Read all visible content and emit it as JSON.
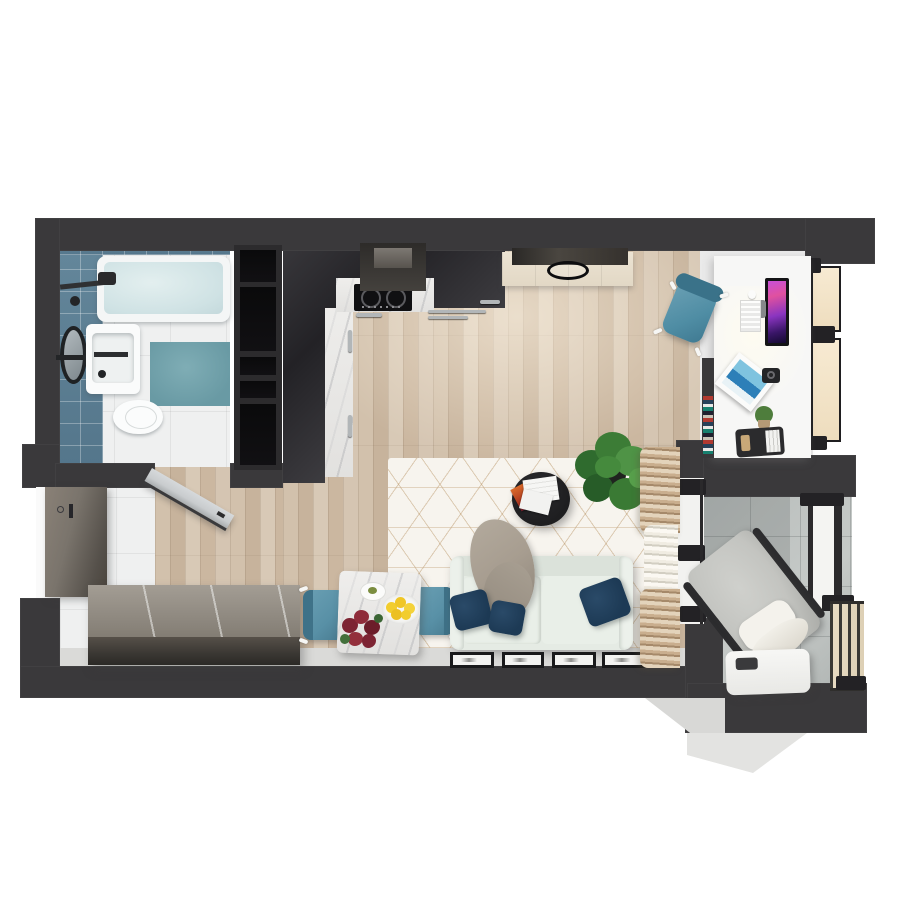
{
  "meta": {
    "title": "Studio apartment – top-down 3D floor plan render",
    "view": "top-down-3d-render",
    "canvas_px": {
      "width": 900,
      "height": 900
    },
    "background": "#ffffff",
    "visible_text": "none"
  },
  "palette": {
    "wall": "#3a393b",
    "niche": "#0a0a0b",
    "tileBlue": "#64879b",
    "bathMatTeal": "#699aa4",
    "woodLight": "#d8c9b6",
    "woodDark": "#c7b39c",
    "hallTile": "#eff0f0",
    "balconyTile": "#bcc1bf",
    "marble": "#efeeec",
    "rugBase": "#f7f4ee",
    "rugLine": "#ba9668",
    "sofa": "#e5ebe4",
    "pillowNavy": "#1d3a55",
    "throwTaupe": "#a79d90",
    "coffeeTableBlack": "#1e1e20",
    "chairBlue": "#5890a6",
    "curtainTan": "#c9ae8e",
    "curtainWhite": "#f0ece2",
    "lemon": "#f2cd2e",
    "flower": "#7d2433",
    "plantGreen": "#3c7c36",
    "glassCream": "#f7ead2",
    "deskWhite": "#f7f7f6",
    "monitorScreenMagenta": "#c84fd8",
    "sideboardTop": "#a39d94",
    "sideboardFront": "#3a3733",
    "doorGray": "#c9ccce",
    "entranceDoorBrownGray": "#7a746c",
    "loungeChairGray": "#c3c4c0"
  },
  "rooms": [
    {
      "id": "bathroom",
      "name": "bathroom",
      "floor": "white tile with blue tiled feature wall",
      "items": [
        "bathtub",
        "shower-mixer",
        "round-mirror",
        "towel-bar",
        "washbasin",
        "toilet",
        "teal-bath-mat",
        "open-interior-door"
      ]
    },
    {
      "id": "entry-hall",
      "name": "entry hall",
      "floor": "white tile",
      "items": [
        "entrance-door",
        "long-dark-sideboard"
      ]
    },
    {
      "id": "kitchen",
      "name": "kitchen",
      "floor": "wood planks",
      "items": [
        "dark-l-shaped-cabinets",
        "white-marble-counter",
        "induction-hob-2-burners",
        "extractor-hood",
        "tall-black-shelving-unit",
        "steel-handle-bars"
      ]
    },
    {
      "id": "living-dining",
      "name": "living / dining room",
      "floor": "wood planks",
      "items": [
        "geometric-white-rug",
        "light-green-sofa",
        "navy-pillows-x3",
        "taupe-throw-blanket",
        "round-black-coffee-table",
        "magazines",
        "potted-plant",
        "square-marble-dining-table",
        "blue-dining-chairs-x2",
        "lemon-bowl",
        "red-flower-vase",
        "small-plate",
        "tv-cabinet-beige",
        "wall-tv-panel",
        "ceiling-lamp-ring",
        "leaning-picture-frames-x4",
        "floor-to-ceiling-curtains"
      ]
    },
    {
      "id": "work-nook",
      "name": "work nook",
      "floor": "white",
      "items": [
        "white-desk",
        "monitor-magenta-screen",
        "white-keyboard",
        "mouse",
        "blue-desk-chair",
        "magazine-rack",
        "camera",
        "cactus-pot",
        "desk-organizer",
        "colorful-book-stack",
        "tilt-open-window"
      ]
    },
    {
      "id": "balcony",
      "name": "balcony",
      "floor": "concrete tiles",
      "items": [
        "gray-lounge-chair",
        "white-pillow",
        "white-blanket",
        "white-side-table",
        "dark-slat-railing",
        "glazed-partition",
        "balcony-window"
      ]
    }
  ],
  "counts": {
    "navy_pillows": 3,
    "picture_frames": 4,
    "dining_chairs": 2,
    "hob_burners": 2,
    "lemons": 5,
    "right_window_panes": 2,
    "shelving_niches": 5
  }
}
